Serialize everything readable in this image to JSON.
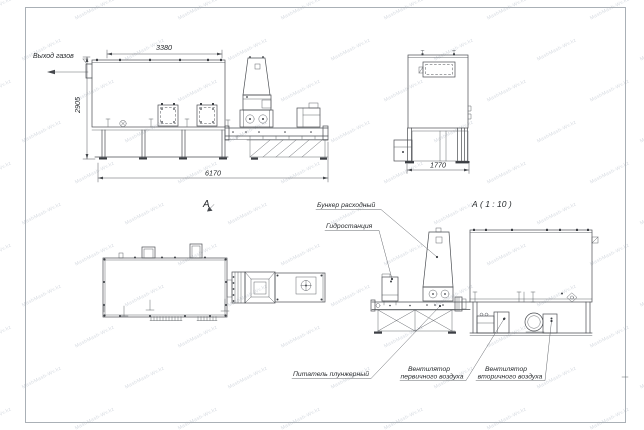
{
  "page": {
    "width": 644,
    "height": 430
  },
  "watermark": {
    "text": "MashMash-Wv.kz",
    "color": "#b9c0cb"
  },
  "colors": {
    "line": "#4a4d52",
    "text": "#26292c",
    "frame": "#aab0b6"
  },
  "titles": {
    "view_a": "А",
    "view_a_scale": "А ( 1 : 10 )"
  },
  "dimensions": {
    "d3380": "3380",
    "d2905": "2905",
    "d6170": "6170",
    "d1770": "1770"
  },
  "callouts": {
    "gas_outlet": "Выход газов",
    "bunker": "Бункер расходный",
    "hydro": "Гидростанция",
    "feeder": "Питатель плунжерный",
    "fan_primary": [
      "Вентилятор",
      "первичного воздуха"
    ],
    "fan_secondary": [
      "Вентилятор",
      "вторичного воздуха"
    ]
  }
}
